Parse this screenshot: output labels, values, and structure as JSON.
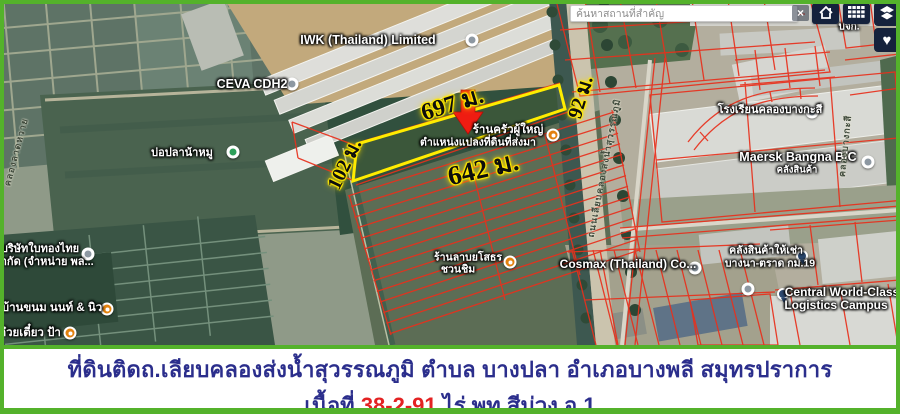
{
  "search": {
    "placeholder": "ค้นหาสถานที่สำคัญ",
    "clear": "×"
  },
  "toolbar": {
    "buttons": [
      "home",
      "grid",
      "layers",
      "favorites"
    ],
    "heart_icon": "♥"
  },
  "colors": {
    "frame_green": "#54b22b",
    "caption_text": "#2b2e8c",
    "caption_highlight": "#e32222",
    "parcel_outline": "#ffec00",
    "cadastral_lines": "#e8301c",
    "arrow": "#ef1c12",
    "ui_dark": "#15223c"
  },
  "map": {
    "parcel": {
      "top_length": "697 ม.",
      "bottom_length": "642 ม.",
      "left_length": "102 ม.",
      "right_length": "92 ม.",
      "note": "ตำแหน่งแปลงที่ดินที่ส่งมา"
    },
    "labels": [
      {
        "t": "IWK (Thailand) Limited",
        "x": 368,
        "y": 40,
        "s": 12.5,
        "cls": "poi"
      },
      {
        "t": "CEVA CDH2",
        "x": 252,
        "y": 84,
        "s": 12.5,
        "cls": "poi"
      },
      {
        "t": "บ่อปลาน้าหมู",
        "x": 182,
        "y": 152,
        "s": 11,
        "cls": "poi"
      },
      {
        "t": "บริษัทใบทองไทย",
        "x": 40,
        "y": 248,
        "s": 11,
        "cls": "poi"
      },
      {
        "t": "จำกัด (จำหน่าย พล...",
        "x": 44,
        "y": 261,
        "s": 11,
        "cls": "poi"
      },
      {
        "t": "บ้านขนม นนท์ & นิว",
        "x": 52,
        "y": 308,
        "s": 11.5,
        "cls": "poi"
      },
      {
        "t": "ก๋วยเตี๋ยว ป้า",
        "x": 30,
        "y": 333,
        "s": 11.5,
        "cls": "poi"
      },
      {
        "t": "ร้านครัวผู้ใหญ่",
        "x": 508,
        "y": 130,
        "s": 11.5,
        "cls": "poi"
      },
      {
        "t": "ตำแหน่งแปลงที่ดินที่ส่งมา",
        "x": 478,
        "y": 142,
        "s": 10.5,
        "cls": "poi"
      },
      {
        "t": "ร้านลาบยโสธร",
        "x": 468,
        "y": 257,
        "s": 10.5,
        "cls": "poi"
      },
      {
        "t": "ชวนชิม",
        "x": 458,
        "y": 269,
        "s": 10.5,
        "cls": "poi"
      },
      {
        "t": "โรงเรียนคลองบางกะสี",
        "x": 770,
        "y": 109,
        "s": 11,
        "cls": "poi"
      },
      {
        "t": "Maersk Bangna B/C",
        "x": 798,
        "y": 157,
        "s": 12.5,
        "cls": "poi"
      },
      {
        "t": "คลังสินค้า",
        "x": 797,
        "y": 170,
        "s": 9.5,
        "cls": "poi"
      },
      {
        "t": "Cosmax (Thailand) Co...",
        "x": 628,
        "y": 264,
        "s": 12,
        "cls": "poi"
      },
      {
        "t": "คลังสินค้าให้เช่า",
        "x": 766,
        "y": 250,
        "s": 10.5,
        "cls": "poi"
      },
      {
        "t": "บางนา-ตราด กม.19",
        "x": 770,
        "y": 263,
        "s": 10.5,
        "cls": "poi"
      },
      {
        "t": "Central World-Class",
        "x": 842,
        "y": 292,
        "s": 12,
        "cls": "poi"
      },
      {
        "t": "Logistics Campus",
        "x": 836,
        "y": 305,
        "s": 12,
        "cls": "poi"
      },
      {
        "t": "บจก.",
        "x": 849,
        "y": 27,
        "s": 10,
        "cls": "poi"
      },
      {
        "t": "ถนนเลียบคลองส่งน้ำสุวรรณภูมิ",
        "x": 604,
        "y": 168,
        "s": 9,
        "r": -79,
        "cls": "road"
      },
      {
        "t": "คลองบางกะสี",
        "x": 845,
        "y": 146,
        "s": 9,
        "r": -84,
        "cls": "road"
      },
      {
        "t": "คลองลาดหวาย",
        "x": 16,
        "y": 152,
        "s": 9,
        "r": -75,
        "cls": "road"
      },
      {
        "t": "697 ม.",
        "x": 452,
        "y": 103,
        "s": 24,
        "r": -17,
        "cls": "measure"
      },
      {
        "t": "642 ม.",
        "x": 483,
        "y": 168,
        "s": 27,
        "r": -13,
        "cls": "measure"
      },
      {
        "t": "102 ม.",
        "x": 344,
        "y": 164,
        "s": 20,
        "r": -64,
        "cls": "measure"
      },
      {
        "t": "92 ม.",
        "x": 580,
        "y": 97,
        "s": 20,
        "r": -73,
        "cls": "measure"
      }
    ],
    "markers": [
      {
        "type": "mk-white",
        "x": 472,
        "y": 40
      },
      {
        "type": "mk-white",
        "x": 292,
        "y": 84
      },
      {
        "type": "mk-green",
        "x": 233,
        "y": 152
      },
      {
        "type": "mk-white",
        "x": 88,
        "y": 254
      },
      {
        "type": "mk-orange",
        "x": 107,
        "y": 309
      },
      {
        "type": "mk-orange",
        "x": 70,
        "y": 333
      },
      {
        "type": "mk-orange",
        "x": 553,
        "y": 135
      },
      {
        "type": "mk-orange",
        "x": 510,
        "y": 262
      },
      {
        "type": "mk-white",
        "x": 812,
        "y": 112
      },
      {
        "type": "mk-white",
        "x": 868,
        "y": 162
      },
      {
        "type": "mk-white",
        "x": 695,
        "y": 268
      },
      {
        "type": "mk-white",
        "x": 748,
        "y": 289
      },
      {
        "type": "mk-pin",
        "x": 802,
        "y": 256
      },
      {
        "type": "mk-pin",
        "x": 783,
        "y": 294
      }
    ]
  },
  "caption": {
    "line1": "ที่ดินติดถ.เลียบคลองส่งน้ำสุวรรณภูมิ ตำบล บางปลา อำเภอบางพลี สมุทรปราการ",
    "area_prefix": "เนื้อที่",
    "area_value": "38-2-91",
    "area_suffix": "ไร่  พท.สีม่วง อ.1"
  }
}
